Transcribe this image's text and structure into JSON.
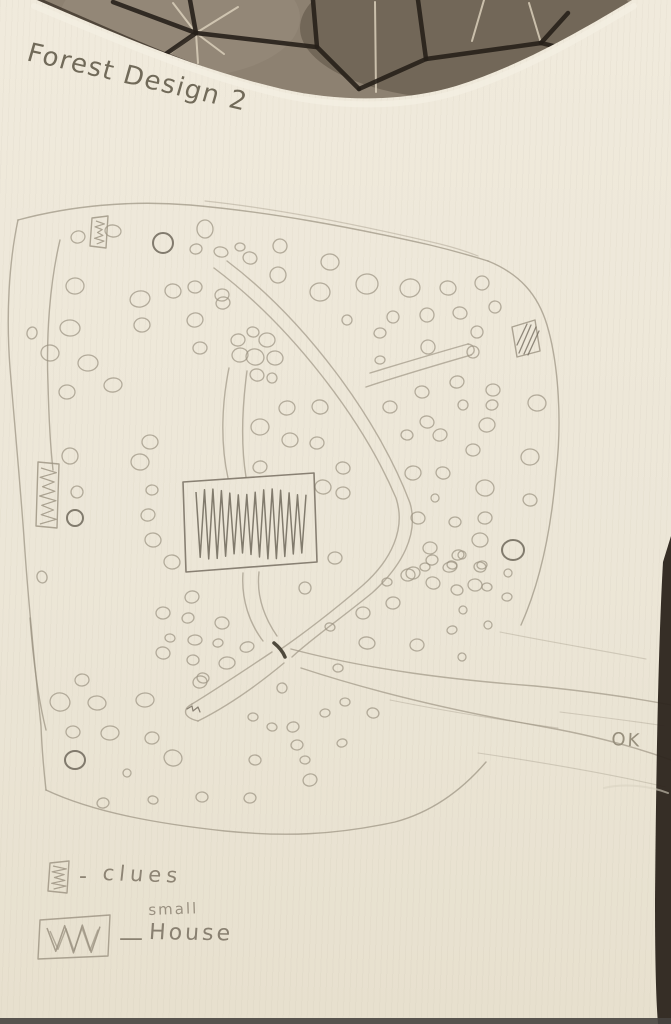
{
  "title": {
    "text": "Forest Design 2"
  },
  "annotations": {
    "ok": "OK"
  },
  "legend": {
    "clue_dash": "-",
    "clue_label": "clues",
    "small_label": "small",
    "house_dash": "—",
    "house_label": "House"
  },
  "colors": {
    "paper": "#ece6d8",
    "pencil": "#9a9180",
    "pencil_bold": "#6f675a",
    "pencil_dark": "#464034",
    "fabric_base": "#8d8171",
    "fabric_dark_line": "#27201a",
    "fabric_light_line": "#d9cfba",
    "photo_edge": "#2c241c",
    "photo_bottom_line": "#474440"
  },
  "fabric": {
    "shape": "M37,0 C120,36 200,70 282,89 C340,102 402,102 456,86 C520,66 582,30 632,0 Z",
    "shade_ellipses": [
      {
        "cx": 470,
        "cy": 28,
        "rx": 170,
        "ry": 72,
        "fill": "rgba(52,42,31,0.30)"
      },
      {
        "cx": 180,
        "cy": 18,
        "rx": 120,
        "ry": 60,
        "fill": "rgba(166,156,138,0.25)"
      }
    ],
    "dark_lines": [
      "M113,2 L196,33",
      "M190,0 L196,33",
      "M196,33 L316,47",
      "M313,0 L317,47",
      "M317,47 L359,89",
      "M359,89 L426,59",
      "M426,59 L541,43",
      "M418,0 L426,59",
      "M541,43 L568,13",
      "M541,43 L603,58 L662,75",
      "M160,58 L196,33"
    ],
    "light_lines": [
      "M196,33 L238,7",
      "M196,33 L224,54",
      "M196,33 L198,63",
      "M196,33 L164,58",
      "M196,33 L173,3",
      "M375,2 L376,92",
      "M484,0 L472,41",
      "M631,17 L613,73",
      "M541,43 L529,3"
    ],
    "edge_shadow": "M40,2 C100,28 160,56 220,76",
    "paper_highlight": "M34,6 C120,42 200,76 282,95 C342,108 404,108 458,92 C522,72 584,36 634,6"
  },
  "photo": {
    "right_strip": "M671,536 L663,562 C658,650 656,780 655,900 C655,960 656,1000 658,1024 L671,1024 Z",
    "bottom_line": {
      "y": 1018,
      "h": 6
    },
    "crease": "M604,788 C625,783 650,786 668,793"
  },
  "map": {
    "boundary_paths": [
      "M18,220 C70,206 130,200 190,205 C270,212 350,227 430,245 C455,251 472,256 488,261",
      "M488,261 C520,274 538,295 547,325 C559,365 562,425 556,472 C551,532 539,585 521,625",
      "M18,220 C9,262 6,315 10,368 C15,430 21,492 25,552 C29,610 35,668 41,726 C42,752 44,772 46,790",
      "M46,790 C95,813 160,824 225,831 C285,837 335,835 395,822 C432,812 462,790 486,762",
      "M60,240 C50,282 46,334 48,384 C49,424 51,452 53,470",
      "M30,618 C33,658 38,698 46,730"
    ],
    "boundary_faint_paths": [
      "M205,201 C280,209 360,225 440,244 C456,248 468,252 478,256"
    ],
    "trail_paths": [
      "M214,268 C290,325 362,418 396,498 C406,528 392,560 362,586 C332,612 300,636 281,649",
      "M227,261 C305,320 378,418 410,503 C419,534 402,566 372,593 C344,616 310,640 292,657",
      "M366,387 C402,375 440,364 471,355",
      "M370,373 C406,362 440,352 468,344",
      "M468,344 C475,345 476,352 471,355",
      "M229,368 C222,402 220,442 228,478",
      "M247,371 C242,408 241,446 246,477",
      "M243,573 C241,600 250,624 263,641",
      "M259,572 C256,598 266,620 277,636",
      "M272,652 C242,672 212,692 192,704",
      "M284,663 C254,688 224,708 198,721",
      "M192,704 C183,709 182,717 198,721",
      "M291,649 C370,670 455,680 535,686 C585,691 635,698 671,705",
      "M301,668 C380,694 465,713 545,727 C595,736 638,748 671,760"
    ],
    "faint_paths": [
      "M390,700 C450,712 515,722 558,728",
      "M478,753 C540,762 610,774 666,787",
      "M500,632 C550,642 610,652 646,659",
      "M560,712 C600,717 640,722 665,726"
    ],
    "junction_mark": "M274,643 C279,647 283,652 285,657",
    "tip_scribble": "M187,709 l5,-3 l1,5 l5,-4 l2,5",
    "trees": [
      [
        78,
        237,
        7,
        6
      ],
      [
        113,
        231,
        8,
        6
      ],
      [
        205,
        229,
        8,
        9
      ],
      [
        196,
        249,
        6,
        5
      ],
      [
        221,
        252,
        7,
        5
      ],
      [
        240,
        247,
        5,
        4
      ],
      [
        280,
        246,
        7,
        7
      ],
      [
        250,
        258,
        7,
        6
      ],
      [
        330,
        262,
        9,
        8
      ],
      [
        75,
        286,
        9,
        8
      ],
      [
        140,
        299,
        10,
        8
      ],
      [
        173,
        291,
        8,
        7
      ],
      [
        195,
        287,
        7,
        6
      ],
      [
        222,
        295,
        7,
        6
      ],
      [
        278,
        275,
        8,
        8
      ],
      [
        320,
        292,
        10,
        9
      ],
      [
        367,
        284,
        11,
        10
      ],
      [
        410,
        288,
        10,
        9
      ],
      [
        448,
        288,
        8,
        7
      ],
      [
        482,
        283,
        7,
        7
      ],
      [
        495,
        307,
        6,
        6
      ],
      [
        32,
        333,
        5,
        6
      ],
      [
        70,
        328,
        10,
        8
      ],
      [
        142,
        325,
        8,
        7
      ],
      [
        223,
        303,
        7,
        6
      ],
      [
        347,
        320,
        5,
        5
      ],
      [
        393,
        317,
        6,
        6
      ],
      [
        427,
        315,
        7,
        7
      ],
      [
        460,
        313,
        7,
        6
      ],
      [
        477,
        332,
        6,
        6
      ],
      [
        380,
        333,
        6,
        5
      ],
      [
        195,
        320,
        8,
        7
      ],
      [
        50,
        353,
        9,
        8
      ],
      [
        88,
        363,
        10,
        8
      ],
      [
        238,
        340,
        7,
        6
      ],
      [
        253,
        332,
        6,
        5
      ],
      [
        267,
        340,
        8,
        7
      ],
      [
        240,
        355,
        8,
        7
      ],
      [
        255,
        357,
        9,
        8
      ],
      [
        275,
        358,
        8,
        7
      ],
      [
        200,
        348,
        7,
        6
      ],
      [
        428,
        347,
        7,
        7
      ],
      [
        473,
        352,
        6,
        6
      ],
      [
        67,
        392,
        8,
        7
      ],
      [
        113,
        385,
        9,
        7
      ],
      [
        257,
        375,
        7,
        6
      ],
      [
        272,
        378,
        5,
        5
      ],
      [
        380,
        360,
        5,
        4
      ],
      [
        457,
        382,
        7,
        6
      ],
      [
        422,
        392,
        7,
        6
      ],
      [
        493,
        390,
        7,
        6
      ],
      [
        287,
        408,
        8,
        7
      ],
      [
        320,
        407,
        8,
        7
      ],
      [
        390,
        407,
        7,
        6
      ],
      [
        463,
        405,
        5,
        5
      ],
      [
        492,
        405,
        6,
        5
      ],
      [
        537,
        403,
        9,
        8
      ],
      [
        260,
        427,
        9,
        8
      ],
      [
        487,
        425,
        8,
        7
      ],
      [
        427,
        422,
        7,
        6
      ],
      [
        290,
        440,
        8,
        7
      ],
      [
        317,
        443,
        7,
        6
      ],
      [
        440,
        435,
        7,
        6
      ],
      [
        407,
        435,
        6,
        5
      ],
      [
        473,
        450,
        7,
        6
      ],
      [
        260,
        467,
        7,
        6
      ],
      [
        343,
        468,
        7,
        6
      ],
      [
        150,
        442,
        8,
        7
      ],
      [
        70,
        456,
        8,
        8
      ],
      [
        77,
        492,
        6,
        6
      ],
      [
        140,
        462,
        9,
        8
      ],
      [
        152,
        490,
        6,
        5
      ],
      [
        148,
        515,
        7,
        6
      ],
      [
        323,
        487,
        8,
        7
      ],
      [
        343,
        493,
        7,
        6
      ],
      [
        413,
        473,
        8,
        7
      ],
      [
        443,
        473,
        7,
        6
      ],
      [
        485,
        488,
        9,
        8
      ],
      [
        530,
        457,
        9,
        8
      ],
      [
        435,
        498,
        4,
        4
      ],
      [
        418,
        518,
        7,
        6
      ],
      [
        455,
        522,
        6,
        5
      ],
      [
        485,
        518,
        7,
        6
      ],
      [
        530,
        500,
        7,
        6
      ],
      [
        480,
        540,
        8,
        7
      ],
      [
        430,
        548,
        7,
        6
      ],
      [
        458,
        555,
        6,
        5
      ],
      [
        172,
        562,
        8,
        7
      ],
      [
        335,
        558,
        7,
        6
      ],
      [
        432,
        560,
        6,
        5
      ],
      [
        452,
        565,
        5,
        4
      ],
      [
        462,
        555,
        4,
        4
      ],
      [
        482,
        565,
        5,
        4
      ],
      [
        42,
        577,
        5,
        6
      ],
      [
        153,
        540,
        8,
        7
      ],
      [
        425,
        567,
        5,
        4
      ],
      [
        450,
        567,
        7,
        5
      ],
      [
        480,
        567,
        6,
        5
      ],
      [
        508,
        573,
        4,
        4
      ],
      [
        408,
        575,
        7,
        6
      ],
      [
        433,
        583,
        7,
        6
      ],
      [
        475,
        585,
        7,
        6
      ],
      [
        507,
        597,
        5,
        4
      ],
      [
        192,
        597,
        7,
        6
      ],
      [
        305,
        588,
        6,
        6
      ],
      [
        387,
        582,
        5,
        4
      ],
      [
        413,
        573,
        7,
        6
      ],
      [
        457,
        590,
        6,
        5
      ],
      [
        487,
        587,
        5,
        4
      ],
      [
        163,
        613,
        7,
        6
      ],
      [
        188,
        618,
        6,
        5
      ],
      [
        222,
        623,
        7,
        6
      ],
      [
        363,
        613,
        7,
        6
      ],
      [
        393,
        603,
        7,
        6
      ],
      [
        330,
        627,
        5,
        4
      ],
      [
        463,
        610,
        4,
        4
      ],
      [
        488,
        625,
        4,
        4
      ],
      [
        452,
        630,
        5,
        4
      ],
      [
        170,
        638,
        5,
        4
      ],
      [
        195,
        640,
        7,
        5
      ],
      [
        218,
        643,
        5,
        4
      ],
      [
        163,
        653,
        7,
        6
      ],
      [
        193,
        660,
        6,
        5
      ],
      [
        227,
        663,
        8,
        6
      ],
      [
        247,
        647,
        7,
        5
      ],
      [
        367,
        643,
        8,
        6
      ],
      [
        417,
        645,
        7,
        6
      ],
      [
        462,
        657,
        4,
        4
      ],
      [
        203,
        678,
        6,
        5
      ],
      [
        338,
        668,
        5,
        4
      ],
      [
        82,
        680,
        7,
        6
      ],
      [
        60,
        702,
        10,
        9
      ],
      [
        97,
        703,
        9,
        7
      ],
      [
        145,
        700,
        9,
        7
      ],
      [
        200,
        682,
        7,
        6
      ],
      [
        282,
        688,
        5,
        5
      ],
      [
        253,
        717,
        5,
        4
      ],
      [
        325,
        713,
        5,
        4
      ],
      [
        373,
        713,
        6,
        5
      ],
      [
        73,
        732,
        7,
        6
      ],
      [
        110,
        733,
        9,
        7
      ],
      [
        293,
        727,
        6,
        5
      ],
      [
        272,
        727,
        5,
        4
      ],
      [
        345,
        702,
        5,
        4
      ],
      [
        152,
        738,
        7,
        6
      ],
      [
        173,
        758,
        9,
        8
      ],
      [
        127,
        773,
        4,
        4
      ],
      [
        297,
        745,
        6,
        5
      ],
      [
        342,
        743,
        5,
        4
      ],
      [
        255,
        760,
        6,
        5
      ],
      [
        305,
        760,
        5,
        4
      ],
      [
        103,
        803,
        6,
        5
      ],
      [
        153,
        800,
        5,
        4
      ],
      [
        202,
        797,
        6,
        5
      ],
      [
        250,
        798,
        6,
        5
      ],
      [
        310,
        780,
        7,
        6
      ]
    ],
    "bold_trees": [
      [
        163,
        243,
        10,
        10
      ],
      [
        75,
        518,
        8,
        8
      ],
      [
        513,
        550,
        11,
        10
      ],
      [
        75,
        760,
        10,
        9
      ]
    ],
    "markers": [
      {
        "name": "clue-box-marker-1",
        "poly": "92,218 108,216 106,248 90,246",
        "fill_type": "zigzag-v",
        "zz": [
          96,
          221,
          103,
          244,
          4
        ]
      },
      {
        "name": "clue-box-marker-2",
        "poly": "512,327 535,320 540,351 517,357",
        "fill_type": "hatch",
        "hatch": [
          "M519,353 L531,325",
          "M524,354 L536,327",
          "M528,355 L539,331",
          "M517,345 L527,324"
        ]
      },
      {
        "name": "small-house-marker",
        "poly": "38,462 59,464 57,528 36,526",
        "fill_type": "zigzag-v",
        "zz": [
          41,
          468,
          55,
          524,
          6
        ]
      },
      {
        "name": "house-marker",
        "poly": "183,482 314,473 317,562 186,572",
        "fill_type": "zigzag-h",
        "zz": [
          196,
          492,
          306,
          556,
          13
        ],
        "bold": true
      },
      {
        "name": "legend-clue-symbol",
        "poly": "50,863 69,861 67,893 48,891",
        "fill_type": "zigzag-v",
        "zz": [
          53,
          866,
          65,
          889,
          4
        ]
      },
      {
        "name": "legend-house-symbol",
        "poly": "40,920 110,915 108,956 38,959",
        "fill_type": "zigzag-h",
        "zz": [
          47,
          928,
          100,
          950,
          3
        ],
        "double": true
      }
    ]
  }
}
